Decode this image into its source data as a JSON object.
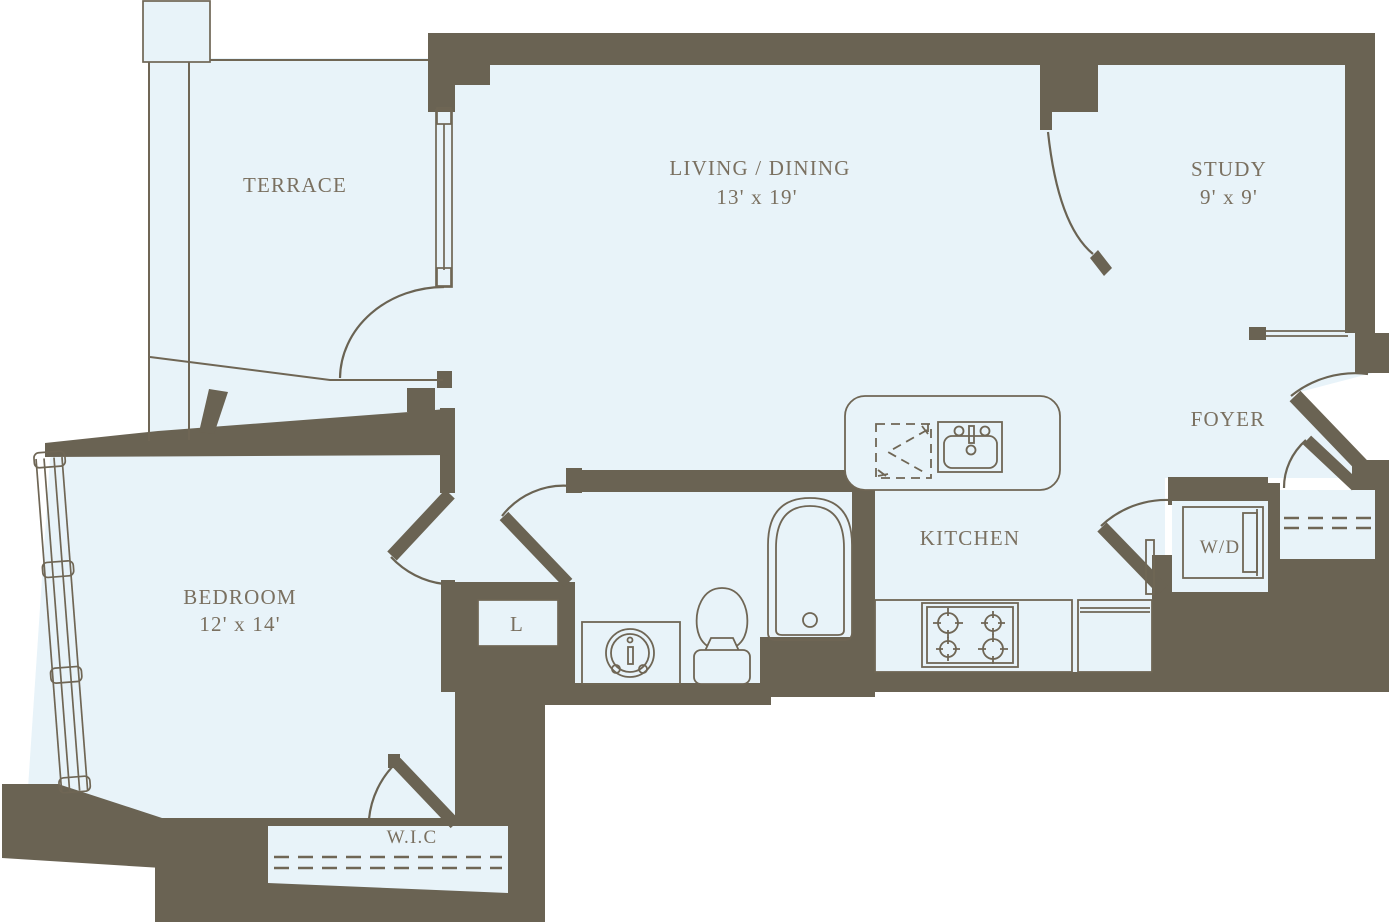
{
  "colors": {
    "wall": "#6a6353",
    "floor": "#e8f3f9",
    "outline": "#6f6655",
    "text": "#7a7060",
    "background": "#ffffff"
  },
  "rooms": {
    "terrace": {
      "label": "TERRACE"
    },
    "living": {
      "label": "LIVING / DINING",
      "dims": "13' x 19'"
    },
    "study": {
      "label": "STUDY",
      "dims": "9' x 9'"
    },
    "foyer": {
      "label": "FOYER"
    },
    "kitchen": {
      "label": "KITCHEN"
    },
    "bedroom": {
      "label": "BEDROOM",
      "dims": "12' x 14'"
    },
    "laundry": {
      "label": "W/D"
    },
    "linen": {
      "label": "L"
    },
    "walk_in_closet": {
      "label": "W.I.C"
    }
  }
}
